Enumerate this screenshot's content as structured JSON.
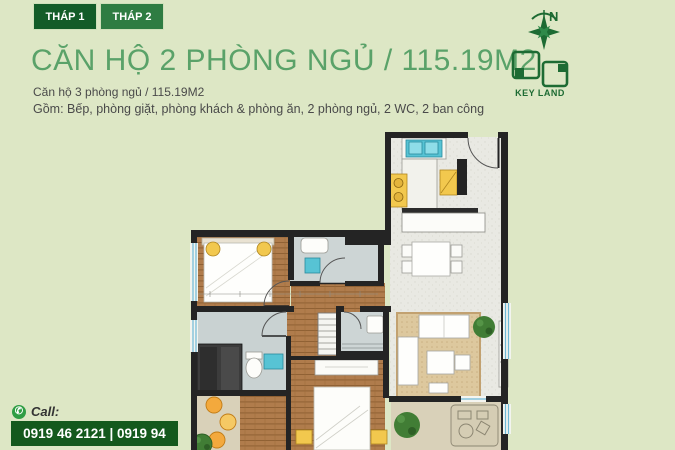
{
  "tabs": [
    {
      "label": "THÁP 1",
      "active": true
    },
    {
      "label": "THÁP 2",
      "active": false
    }
  ],
  "header": {
    "title": "CĂN HỘ 2 PHÒNG NGỦ / 115.19M2",
    "subtitle": "Căn hộ 3 phòng ngủ / 115.19M2",
    "description": "Gồm: Bếp, phòng giặt, phòng khách & phòng ăn, 2 phòng ngủ, 2 WC, 2 ban công"
  },
  "compass": {
    "north_label": "N"
  },
  "logo": {
    "text": "KEY LAND"
  },
  "contact": {
    "call_label": "Call:",
    "phones": "0919 46 2121 | 0919 94 2121"
  },
  "colors": {
    "background": "#dde7c5",
    "tab_active": "#135c28",
    "tab_inactive": "#2e7c42",
    "title_green": "#5aa269",
    "brand_green": "#1d6b33",
    "phone_box_bg": "#14591d",
    "phone_icon_green": "#2f9e44",
    "plan_wall": "#242424",
    "plan_wood": "#b07c4c",
    "plan_tile": "#e9e9e3",
    "plan_bath": "#cdd5d5",
    "plan_rug": "#ddc89e",
    "plan_balcony": "#d9d1b9",
    "fixture_teal": "#57c3d4",
    "fixture_yellow": "#f2c84e",
    "stool_orange": "#f3a93d",
    "plant_green": "#417d35",
    "window_blue": "#6fb9d6"
  }
}
